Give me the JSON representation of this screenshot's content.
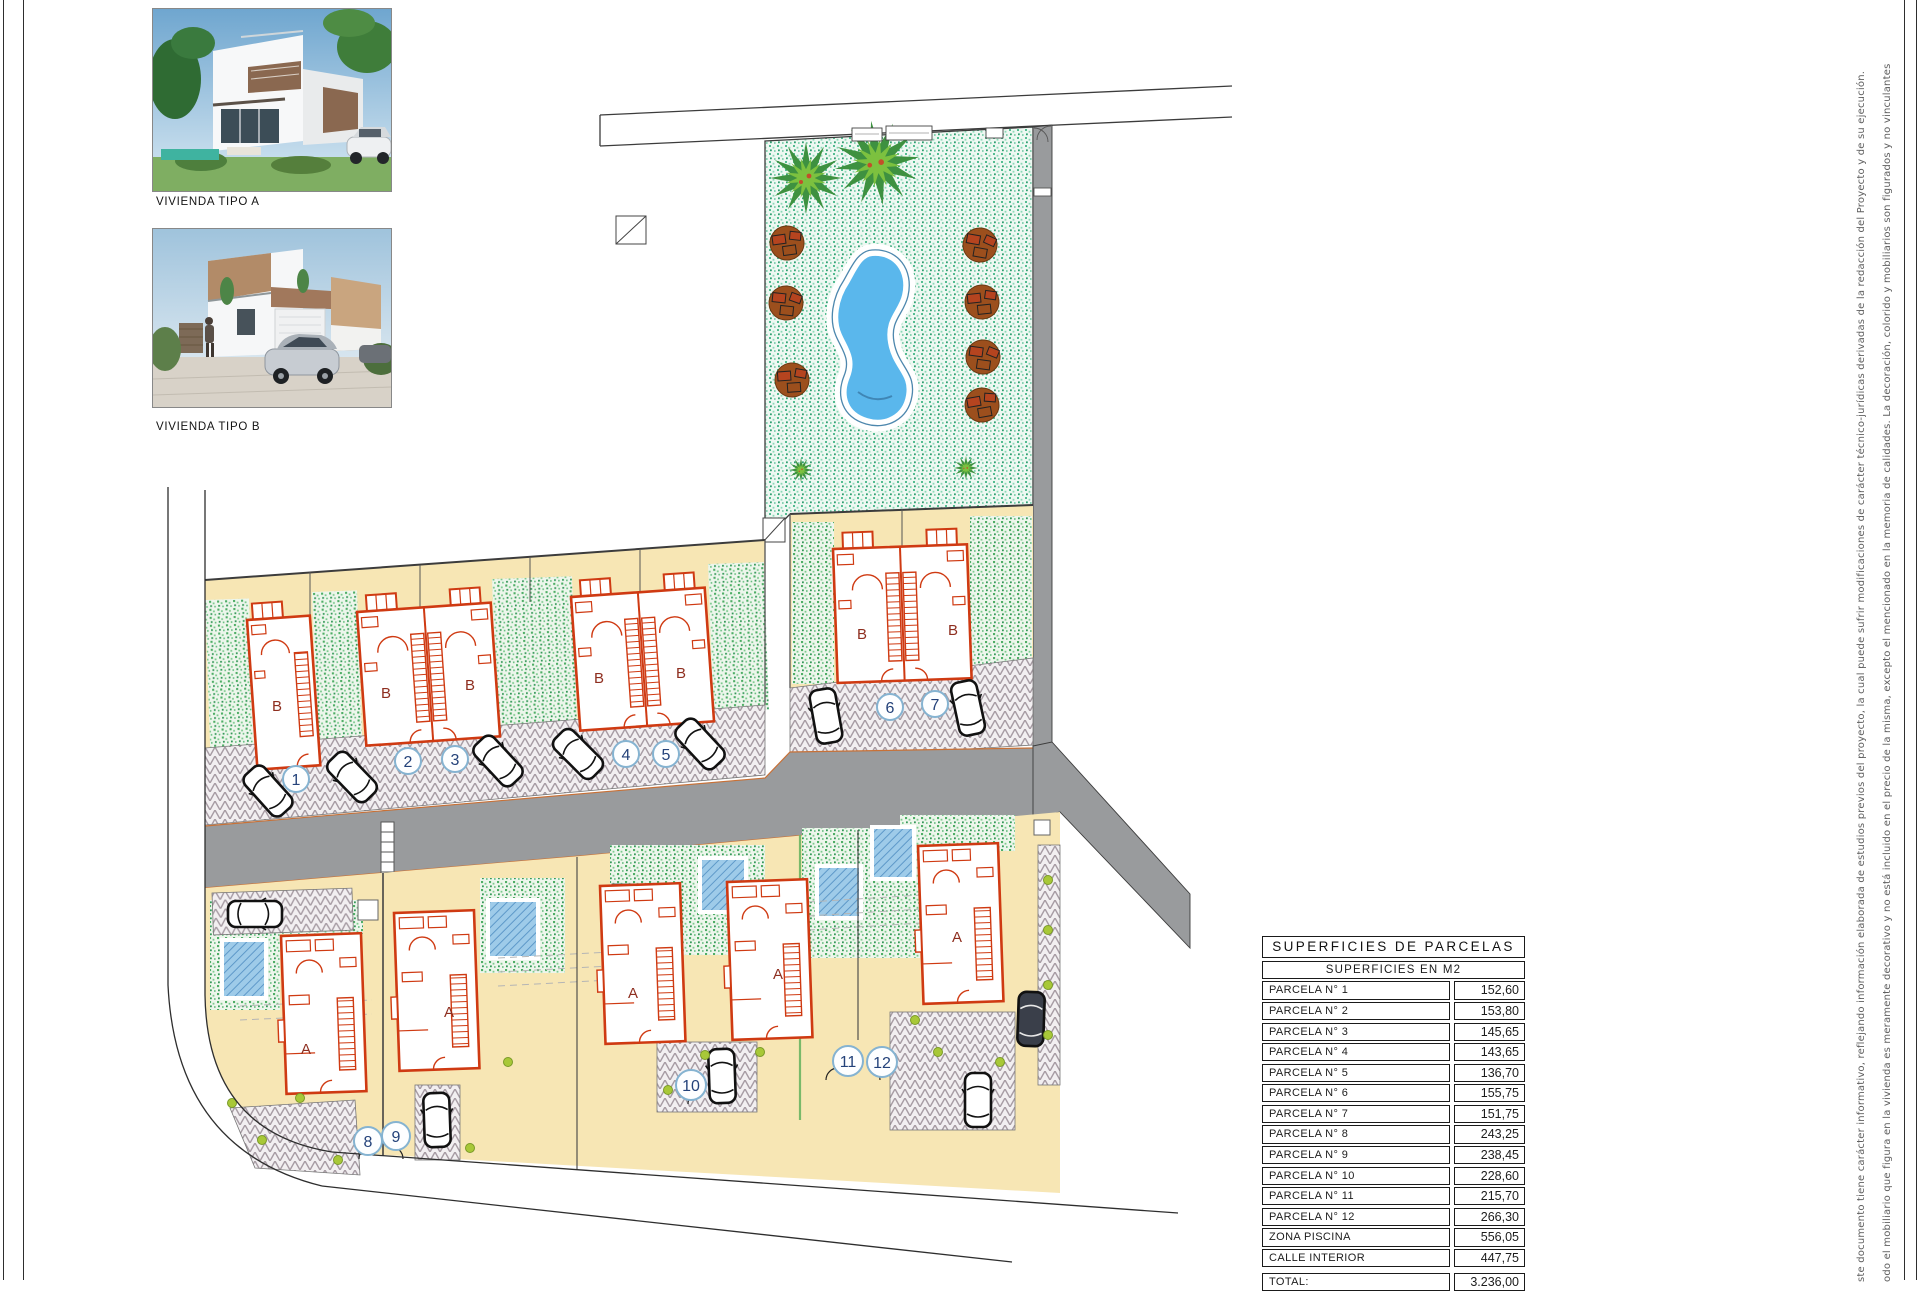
{
  "photos": {
    "a": {
      "label": "VIVIENDA TIPO A"
    },
    "b": {
      "label": "VIVIENDA TIPO B"
    }
  },
  "plan": {
    "house_type_a_label": "A",
    "house_type_b_label": "B",
    "plot_numbers": [
      "1",
      "2",
      "3",
      "4",
      "5",
      "6",
      "7",
      "8",
      "9",
      "10",
      "11",
      "12"
    ]
  },
  "table": {
    "title": "SUPERFICIES  DE  PARCELAS",
    "subtitle": "SUPERFICIES  EN  M2",
    "rows": [
      {
        "label": "PARCELA  N°  1",
        "value": "152,60"
      },
      {
        "label": "PARCELA  N°  2",
        "value": "153,80"
      },
      {
        "label": "PARCELA  N°  3",
        "value": "145,65"
      },
      {
        "label": "PARCELA  N°  4",
        "value": "143,65"
      },
      {
        "label": "PARCELA  N°  5",
        "value": "136,70"
      },
      {
        "label": "PARCELA  N°  6",
        "value": "155,75"
      },
      {
        "label": "PARCELA  N°  7",
        "value": "151,75"
      },
      {
        "label": "PARCELA  N°  8",
        "value": "243,25"
      },
      {
        "label": "PARCELA  N°  9",
        "value": "238,45"
      },
      {
        "label": "PARCELA  N°  10",
        "value": "228,60"
      },
      {
        "label": "PARCELA  N°  11",
        "value": "215,70"
      },
      {
        "label": "PARCELA  N°  12",
        "value": "266,30"
      },
      {
        "label": "ZONA  PISCINA",
        "value": "556,05"
      },
      {
        "label": "CALLE  INTERIOR",
        "value": "447,75"
      }
    ],
    "total": {
      "label": "TOTAL:",
      "value": "3.236,00"
    }
  },
  "disclaimer": {
    "line1": "ste documento tiene carácter informativo, reflejando información elaborada de estudios previos del proyecto, la cual puede sufrir modificaciones de carácter técnico-jurídicas derivadas de la redacción del Proyecto y de su ejecución.",
    "line2": "odo el mobiliario que figura en la vivienda es meramente decorativo y no está incluido en el precio de la misma, excepto el mencionado en la memoria de calidades. La decoración, colorido y mobiliarios son figurados y no vinculantes"
  },
  "colors": {
    "plot_cream": "#f7e6b4",
    "road_gray": "#999b9d",
    "house_red": "#cf3a12",
    "label_red": "#8e2e1f",
    "pool_blue": "#5ab7ec",
    "small_pool_blue": "#9ecbe9",
    "grass_green": "#4fae66",
    "circle_ring_blue": "#85b3d1",
    "circle_text_navy": "#24427a"
  }
}
